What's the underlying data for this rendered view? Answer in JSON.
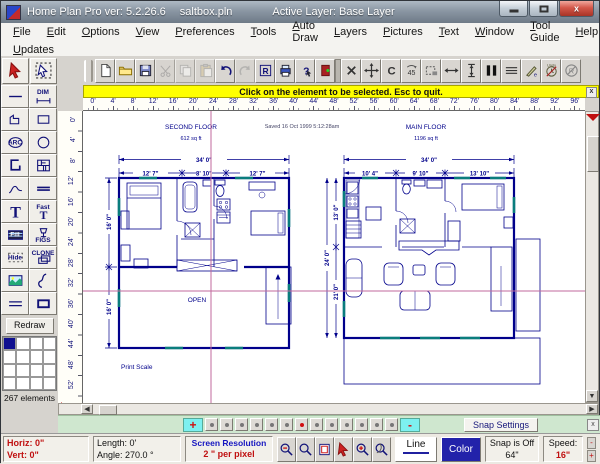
{
  "window": {
    "title": "Home Plan Pro ver: 5.2.26.6",
    "filename": "saltbox.pln",
    "active_layer": "Active Layer: Base Layer",
    "controls": [
      "minimize",
      "maximize",
      "close"
    ],
    "close_glyph": "x"
  },
  "menu": {
    "items": [
      "File",
      "Edit",
      "Options",
      "View",
      "Preferences",
      "Tools",
      "Auto Draw",
      "Layers",
      "Pictures",
      "Text",
      "Window",
      "Tool Guide",
      "Help"
    ],
    "row2": [
      "Updates"
    ]
  },
  "toolbar": [
    {
      "name": "new",
      "icon": "page"
    },
    {
      "name": "open",
      "icon": "folder"
    },
    {
      "name": "save",
      "icon": "disk"
    },
    {
      "name": "cut",
      "icon": "scissors",
      "disabled": true
    },
    {
      "name": "copy",
      "icon": "copy",
      "disabled": true
    },
    {
      "name": "paste",
      "icon": "paste",
      "disabled": true
    },
    {
      "name": "undo",
      "icon": "undo"
    },
    {
      "name": "redo",
      "icon": "redo",
      "disabled": true
    },
    {
      "name": "redraw",
      "icon": "rbox"
    },
    {
      "name": "print",
      "icon": "printer"
    },
    {
      "name": "help-pointer",
      "icon": "help"
    },
    {
      "name": "exit",
      "icon": "exit"
    },
    {
      "name": "delete",
      "icon": "xdel",
      "sep": true
    },
    {
      "name": "move",
      "icon": "move"
    },
    {
      "name": "rotate",
      "icon": "rotc"
    },
    {
      "name": "rotate-45",
      "icon": "rot45"
    },
    {
      "name": "select-region",
      "icon": "region"
    },
    {
      "name": "stretch-horizontal",
      "icon": "harrow"
    },
    {
      "name": "stretch-vertical",
      "icon": "varrow"
    },
    {
      "name": "door-tool",
      "icon": "doorbars"
    },
    {
      "name": "multi-line",
      "icon": "mlines"
    },
    {
      "name": "draw-pen",
      "icon": "pen"
    },
    {
      "name": "undo-timer",
      "icon": "clock"
    },
    {
      "name": "no-redraw",
      "icon": "nor"
    }
  ],
  "message_bar": {
    "text": "Click on the element to be selected.  Esc to quit.",
    "close_glyph": "x"
  },
  "ruler": {
    "horizontal": [
      "0'",
      "4'",
      "8'",
      "12'",
      "16'",
      "20'",
      "24'",
      "28'",
      "32'",
      "36'",
      "40'",
      "44'",
      "48'",
      "52'",
      "56'",
      "60'",
      "64'",
      "68'",
      "72'",
      "76'",
      "80'",
      "84'",
      "88'",
      "92'",
      "96'"
    ],
    "vertical": [
      "0'",
      "4'",
      "8'",
      "12'",
      "16'",
      "20'",
      "24'",
      "28'",
      "32'",
      "36'",
      "40'",
      "44'",
      "48'",
      "52'"
    ]
  },
  "sidebar": {
    "tools": [
      {
        "name": "select-tool",
        "icon": "cursor_red"
      },
      {
        "name": "select-element-tool",
        "icon": "cursor_sel"
      },
      {
        "name": "line-tool",
        "icon": "hline"
      },
      {
        "name": "dimension-tool",
        "icon": "dimsmall",
        "label": "DIM",
        "label_pos": "top"
      },
      {
        "name": "polyline-tool",
        "icon": "poly"
      },
      {
        "name": "rectangle-tool",
        "icon": "rect"
      },
      {
        "name": "arc-tool",
        "icon": "arc",
        "label": "ARC"
      },
      {
        "name": "circle-tool",
        "icon": "circle"
      },
      {
        "name": "wall-tool",
        "icon": "wall"
      },
      {
        "name": "windows-doors-tool",
        "icon": "windoor"
      },
      {
        "name": "ramp-tool",
        "icon": "ramp"
      },
      {
        "name": "double-line-tool",
        "icon": "dbl"
      },
      {
        "name": "text-tool",
        "icon": "textT"
      },
      {
        "name": "fast-text-tool",
        "icon": "textTs",
        "label": "Fast",
        "label_pos": "top"
      },
      {
        "name": "fill-tool",
        "icon": "fillic",
        "label": "Fill",
        "label_style": "lite"
      },
      {
        "name": "figures-tool",
        "icon": "figs",
        "label": "FIGS",
        "label_pos": "bot"
      },
      {
        "name": "hide-tool",
        "icon": "hide",
        "label": "Hide"
      },
      {
        "name": "clone-tool",
        "icon": "clone",
        "label": "CLONE",
        "label_pos": "top"
      },
      {
        "name": "picture-tool",
        "icon": "picture"
      },
      {
        "name": "freehand-tool",
        "icon": "freehand"
      },
      {
        "name": "parallel-lines-tool",
        "icon": "parallel"
      },
      {
        "name": "filled-rectangle-tool",
        "icon": "fillrect"
      }
    ],
    "redraw_label": "Redraw",
    "grid": {
      "rows": 4,
      "cols": 4,
      "active_cell": 0
    },
    "elements_count": "267 elements",
    "mode_label": "USAMode"
  },
  "canvas": {
    "saved_stamp": "Saved 16 Oct 1999  5:12:28am",
    "print_scale_label": "Print Scale",
    "plans": [
      {
        "title": "SECOND FLOOR",
        "area": "612 sq ft",
        "width_total": "34' 0\"",
        "width_segments": [
          "12' 7\"",
          "8' 10\"",
          "12' 7\""
        ],
        "side_dims": [
          "16' 0\"",
          "16' 0\""
        ],
        "room_label": "OPEN"
      },
      {
        "title": "MAIN FLOOR",
        "area": "1196 sq ft",
        "width_total": "34' 0\"",
        "width_segments": [
          "10' 4\"",
          "9' 10\"",
          "13' 10\""
        ],
        "side_dims": [
          "13' 0\"",
          "24' 0\"",
          "21' 0\""
        ]
      }
    ],
    "crosshair_color": "#c2699c",
    "plan_line_color": "#00008b",
    "window_accent_color": "#0a7d7d"
  },
  "zoom_bar": {
    "plus_label": "+",
    "minus_label": "-",
    "levels": 13,
    "selected_index": 6,
    "snap_settings_label": "Snap Settings",
    "close_glyph": "x"
  },
  "status_bar": {
    "horiz": "Horiz: 0\"",
    "vert": "Vert:  0\"",
    "length": "Length:  0'",
    "angle": "Angle:  270.0 °",
    "res_title": "Screen Resolution",
    "res_value": "2 \" per pixel",
    "buttons": [
      {
        "name": "zoom-out",
        "icon": "magm"
      },
      {
        "name": "zoom-window",
        "icon": "mag"
      },
      {
        "name": "fit-page",
        "icon": "pagefit"
      },
      {
        "name": "pointer-mode",
        "icon": "cursor_red"
      },
      {
        "name": "zoom-in",
        "icon": "magp"
      },
      {
        "name": "zoom-previous",
        "icon": "magr"
      }
    ],
    "line_label": "Line",
    "color_label": "Color",
    "snap_line1": "Snap is Off",
    "snap_line2": "64\"",
    "speed_label": "Speed:",
    "speed_value": "16\"",
    "speed_minus": "-",
    "speed_plus": "+"
  }
}
